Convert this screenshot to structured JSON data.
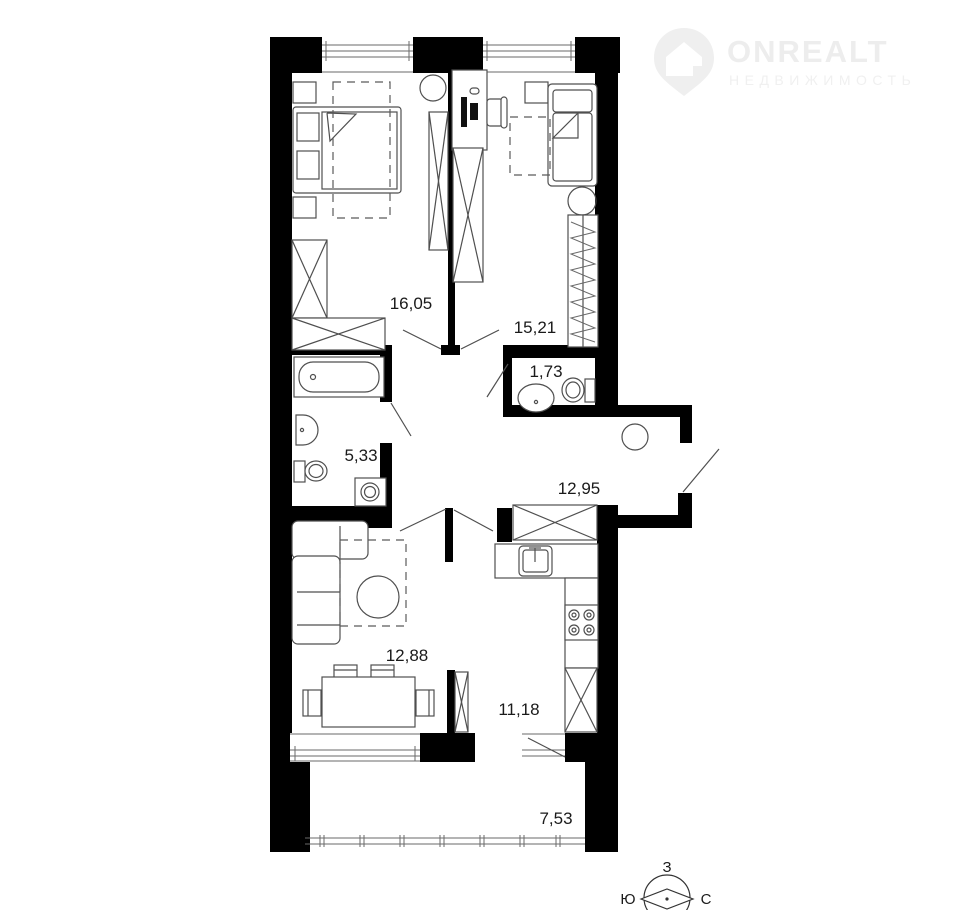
{
  "brand": {
    "name": "ONREALT",
    "tagline": "НЕДВИЖИМОСТЬ"
  },
  "plan": {
    "rooms": [
      {
        "name": "bedroom-1",
        "area": "16,05"
      },
      {
        "name": "bedroom-2",
        "area": "15,21"
      },
      {
        "name": "wc",
        "area": "1,73"
      },
      {
        "name": "bathroom",
        "area": "5,33"
      },
      {
        "name": "hallway",
        "area": "12,95"
      },
      {
        "name": "living-room",
        "area": "12,88"
      },
      {
        "name": "kitchen",
        "area": "11,18"
      },
      {
        "name": "balcony",
        "area": "7,53"
      }
    ]
  },
  "compass": {
    "west": "З",
    "south": "Ю",
    "north": "С"
  },
  "colors": {
    "wall": "#000000",
    "furniture_line": "#4f4f4f",
    "label": "#1a1a1a",
    "watermark": "#ededed"
  }
}
